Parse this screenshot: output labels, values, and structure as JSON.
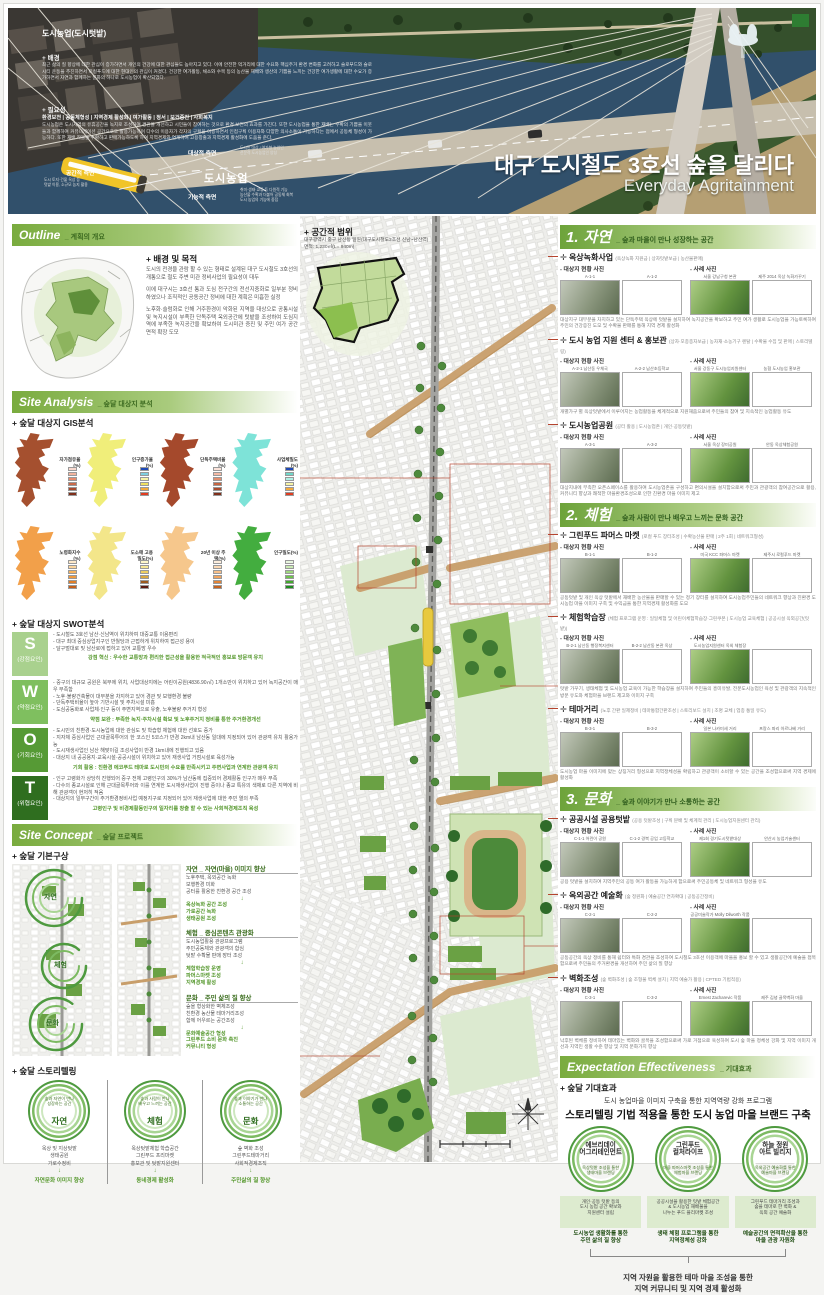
{
  "banner": {
    "photo_heading": "도시농업(도시텃밭)",
    "background_label": "+ 배경",
    "background_text": "최근 삶의 질 향상에 대한 관심이 증가하면서 개인의 건강에 대한 관심들도 높아지고 있다. 이에 안전한 먹거리에 대한 수요와 핵심주거 환경 변화를 고려하고 슬로푸드와 슬로시티 운동을 추진하면서 로컬푸드에 대한 현대인의 관심이 커졌다. 건강한 여가활동, 채소와 수목 등의 농산물 재배와 생산의 기쁨을 느끼는 건강한 여가생활에 대한 수요가 증가하면서 자연과 함께하는 문화의 하나로 도시농업이 확산되었다.",
    "need_label": "+ 필요성",
    "need_keywords": "환경보전 | 공동체형성 | 지역경제 활성화 | 여가활동 | 정서 | 보건증진 | 사회복지",
    "need_text": "도시농업은 도시지역의 유휴공간을 녹지로 조성하여 경관을 개선하고 시민들이 참여하는 것으로 환경 보전의 효과를 가진다. 또한 도시농업을 통한 재배는 수확의 기쁨을 이웃들과 함께하여 커뮤니케이션 공간으로도 활용가능하며 다수의 이용자가 각자의 구획을 이용하면서 인접구획 이용자와 다양한 의사소통이 가능하다는 점에서 공동체 형성이 가능하다. 또한 재배 작물을 수확하고 판매가능하도록 하여 지역경제와 연계하여 고용창출과 지역경제 활성화에 도움을 준다.",
    "diagram": {
      "center": "도시농업",
      "spatial_label": "공간적 측면",
      "spatial_desc": "도시 토지·건물 옥상 등\n텃밭 이용, 소규모 농지 활용",
      "target_label": "대상적 측면",
      "target_desc": "도시민 대상 / 여가형 농업인\n전문적 도시농업인 양성",
      "functional_label": "기능적 측면",
      "functional_desc": "취미·생태·교류 등 다원적 기능\n농산물 수확과 더불어 공동체 회복\n도시 농업의 기능에 중점"
    },
    "title_ko": "대구 도시철도 3호선 숲을 달리다",
    "title_en": "Everyday Agritainment"
  },
  "outline": {
    "header": "Outline",
    "header_sub": "_ 계획의 개요",
    "purpose_label": "+ 배경 및 목적",
    "purpose_items": [
      "도시의 전경을 관람 할 수 있는 형태로 설계된 대구 도시철도 3호선의 개통으로 철도 주변 미관 정비사업의 필요성이 대두",
      "이에 대구시는 3호선 통과 도심 전구간의 전선지중화로 일부분 정비하였으나 조직적인 공동공간 정비에 대한 계획은 미흡한 실정",
      "노후화·슬럼화로 인해 거주환경이 악화된 지역을 대상으로 공통시설 및 녹지시설이 부족한 단독주택 옥외공간에 텃밭을 조성하여 도심지역에 부족한 녹지공간을 확보하여 도시미관 증진 및 주민 여가 공간 면적 확장 도모"
    ],
    "scope_label": "+ 공간적 범위",
    "scope_text": "대구광역시 중구 남산동 일원(대구도시철도3호선 신남~남산역)",
    "scope_area": "면적: 1,230㎡(L= 940m)"
  },
  "analysis": {
    "header": "Site Analysis",
    "header_sub": "_ 숲달 대상지 분석",
    "gis_label": "+ 숲달 대상지 GIS분석",
    "gis_maps": [
      {
        "label": "자가점유율(%)",
        "color": "#a5502f",
        "legend": [
          "#f9d9cf",
          "#f2b49e",
          "#e68a6c",
          "#c96a4a",
          "#a84a2e",
          "#7e2f1a"
        ]
      },
      {
        "label": "인구증가율(%)",
        "color": "#f0ee7a",
        "legend": [
          "#1f49b5",
          "#7ecfe0",
          "#f6f3a5",
          "#f0e060",
          "#f2a93b",
          "#e03c20"
        ]
      },
      {
        "label": "단독주택비율(%)",
        "color": "#a5492c",
        "legend": [
          "#fbe3da",
          "#f3b9a4",
          "#e08d6e",
          "#c46542",
          "#a84a2e",
          "#7e2f1a"
        ]
      },
      {
        "label": "사업체밀도(%)",
        "color": "#7ee3d8",
        "legend": [
          "#1f49b5",
          "#6fd6c8",
          "#aef0e4",
          "#f6f3a5",
          "#f2a93b",
          "#e03c20"
        ]
      },
      {
        "label": "노령화지수(%)",
        "color": "#f2a04a",
        "legend": [
          "#fde8c8",
          "#fbd49b",
          "#f7b45e",
          "#f09a3e",
          "#e07f28",
          "#c45f1a"
        ]
      },
      {
        "label": "도소매 고용밀도(%)",
        "color": "#f3e68a",
        "legend": [
          "#fdf6c9",
          "#f7e795",
          "#eecf62",
          "#d9a83f",
          "#9c5a1e",
          "#5c1a10"
        ]
      },
      {
        "label": "20년 이상 주택(%)",
        "color": "#f6c78c",
        "legend": [
          "#fdeedd",
          "#fbd9b4",
          "#f7c08a",
          "#f0a45e",
          "#e08438",
          "#c4621f"
        ]
      },
      {
        "label": "인구밀도(%)",
        "color": "#43ad3f",
        "legend": [
          "#e8f6df",
          "#c8e9b2",
          "#9ed77f",
          "#6fc24f",
          "#42a82e",
          "#1f8c1f"
        ]
      }
    ],
    "swot_label": "+ 숲달 대상지 SWOT분석",
    "swot": [
      {
        "letter": "S",
        "label": "(강점요인)",
        "color": "#a9d18e",
        "bullets": [
          "도시철도 3호선 남산·신남역이 위치하여 대중교통 이용편리",
          "대구 최대 중심상업지구인 반월당과 근접하게 위치하여 접근성 용이",
          "달구벌대로 및 남산로에 접하고 있어 교통망 우수"
        ],
        "summary": "강점 혁신 : 우수한 교통망과 편리한 접근성을 활용한 적극적인 홍보로 방문객 유치"
      },
      {
        "letter": "W",
        "label": "(약점요인)",
        "color": "#7fbf5f",
        "bullets": [
          "중구의 대규모 공원은 북부에 위치, 사업대상지에는 어린이공원(4836.90㎡) 1개소만이 위치하고 있어 녹지공간이 매우 부족함",
          "노후·불량건축물이 대부분을 차지하고 있어 경관 및 보행환경 불량",
          "단독주택비율이 높아 기반시설 및 주차시설 미흡",
          "도심공동화로 사업체·인구 등이 주변지역으로 유출, 노후불량 주거지 형성"
        ],
        "summary": "약점 보완 : 부족한 녹지·주차시설 확보 및 노후주거지 정비를 통한 주거환경개선"
      },
      {
        "letter": "O",
        "label": "(기회요인)",
        "color": "#569a35",
        "bullets": [
          "도시민의 친환경·도시농업에 대한 관심도 및 학습형 체험에 대한 선호도 증가",
          "지자체 중심사업인 근대골목투어의 한 코스인 5코스가 반경 2km내 남산동 일대에 지정되어 있어 관광객 유치 활용가능",
          "도시재생사업인 남산 해맞이길 조성사업이 반경 1km내에 진행되고 있음",
          "대상지 내 공공용지·교육시설·공공시설이 위치하고 있어 재생사업 거점시설로 육성가능"
        ],
        "summary": "기회 활용 : 친환경 에코푸드 테마로 도시민의 수요를 만족시키고 주변사업과 연계한 관광객 유치"
      },
      {
        "letter": "T",
        "label": "(위협요인)",
        "color": "#2f6e1f",
        "bullets": [
          "인구 고령화가 상당히 진행되어 중구 전체 고령인구의 30%가 남산동에 집중되어 경제활동 인구가 매우 부족",
          "다수의 종교시설로 인해 근대골목투어와 이를 연계한 도시재생사업이 진행 중이나 종교 특유의 색채로 다른 지역에 비해 관광객이 현저히 적음",
          "대상지의 일부구간이 주거환경정비사업 예정지구로 지정되어 있어 재생사업에 대한 주민 열의 부족"
        ],
        "summary": "고령인구 및 비경제활동인구의 일자리를 창출 할 수 있는 사회적경제조직 육성"
      }
    ]
  },
  "concept": {
    "header": "Site Concept",
    "header_sub": "_ 숲달 프로젝트",
    "basic_label": "+ 숲달 기본구상",
    "themes": [
      {
        "title": "자연 _ 자연(마을) 이미지 향상",
        "items": "노후주택, 옥외공간 녹화\n보행환경 미화\n공터를 활용한 친환경 공간 조성",
        "result": "옥상녹화 공간 조성\n가로공간 녹화\n생태공원 조성"
      },
      {
        "title": "체험 _ 중심콘텐츠 관광화",
        "items": "도시농업활용 관광프로그램\n주민공동체와 관광객의 합심\n텃밭 수확물 판매 장터 조성",
        "result": "체험학습장 운영\n파머스마켓 조성\n지역경제 활성"
      },
      {
        "title": "문화 _ 주민 삶의 질 향상",
        "items": "숲을 형상화한 벽체조성\n친환경 농산물 테마거리조성\n함께 어우르는 공간조성",
        "result": "문화예술공간 형성\n그린푸드 소비 문화 촉진\n커뮤니티 형성"
      }
    ],
    "story_label": "+ 숲달 스토리텔링",
    "stories": [
      {
        "tagline": "숲과 자연이 만나\n성장하는 공간",
        "name": "자연",
        "items": "옥상 및 지상텃밭\n생태공원\n가로수정비",
        "result": "자연문화 이미지 향상"
      },
      {
        "tagline": "숲과 사람이 만나\n배우고 느끼는 공간",
        "name": "체험",
        "items": "옥상텃밭체험 학습공간\n그린푸드 프리마켓\n홍보관 및 텃밭지원센터",
        "result": "동네경제 활성화"
      },
      {
        "tagline": "숲과 이야기가 만나\n소통하는 공간",
        "name": "문화",
        "items": "숲 벽화 조성\n그린푸드테마거리\n사회적경제조직",
        "result": "주민삶의 질 향상"
      }
    ]
  },
  "labels": {
    "site_photos": "- 대상지 현황 사진",
    "case_photos": "- 사례 사진",
    "arrow": "↓"
  },
  "sections": [
    {
      "num": "1.",
      "name": "자연",
      "tagline": "_ 숲과 마을이 만나 성장하는 공간",
      "programs": [
        {
          "title": "옥상녹화사업",
          "tags": "(옥상녹화 지원금 | 상자텃밭보급 | 농산물판매)",
          "site_photos": [
            {
              "label": "A-1-1"
            },
            {
              "label": "A-1-2"
            }
          ],
          "case_photos": [
            {
              "label": "서울 강남구청 본관"
            },
            {
              "label": "제주 2014 옥상 녹화가꾸기"
            }
          ],
          "caption": "대상지구 대부분을 차지하고 있는 단독주택 옥상에 텃밭을 설치하여 녹지공간을 확보하고 주민 여가 생활로 도시농업을 가능토록하여 주민의 건강증진 도모 및 수확물 판매를 통해 지역 경제 활성화"
        },
        {
          "title": "도시 농업 지원 센터 & 홍보관",
          "tags": "(상자·모종종자보급 | 농자재·소농기구 렌탈 | 수확물 수집 및 판매 | 스토리텔링)",
          "site_photos": [
            {
              "label": "A-2-1 남산동 우체국"
            },
            {
              "label": "A-2-2 남산초등학교"
            }
          ],
          "case_photos": [
            {
              "label": "서울 강동구 도시농업지원센터"
            },
            {
              "label": "농협 도시농업 홍보관"
            }
          ],
          "caption": "개별가구 별 옥상텃밭에서 이루어지는 농업활동을 체계적으로 지원해줌으로써 주민들의 참여 및 지속적인 농업활동 유도"
        },
        {
          "title": "도시농업공원",
          "tags": "(공터 활용 | 도시농업존 | 개인·공동텃밭)",
          "site_photos": [
            {
              "label": "A-3-1"
            },
            {
              "label": "A-3-2"
            }
          ],
          "case_photos": [
            {
              "label": "서울 옥상 장미공원"
            },
            {
              "label": "안동 옥상체험공원"
            }
          ],
          "caption": "대상지내에 부족한 오픈스페이스를 활용하여 도시농업존을 구성하고 편의시설을 설치함으로써 주민과 관광객의 참여공간으로 활용, 커뮤니티 향상과 쾌적한 마을환경조성으로 인한 친환경 마을 이미지 제고"
        }
      ]
    },
    {
      "num": "2.",
      "name": "체험",
      "tagline": "_ 숲과 사람이 만나 배우고 느끼는 문화 공간",
      "programs": [
        {
          "title": "그린푸드 파머스 마켓",
          "tags": "(로컬 푸드 장터조성 | 수확농산물 판매 | 2주 1회 | 네트워크형성)",
          "site_photos": [
            {
              "label": "B-1-1"
            },
            {
              "label": "B-1-2"
            }
          ],
          "case_photos": [
            {
              "label": "미국 KCC 파머스 마켓"
            },
            {
              "label": "제주시 로컬푸드 마켓"
            }
          ],
          "caption": "공동텃밭 및 개인 옥상 텃밭에서 재배한 농산물을 판매할 수 있는 정기 장터를 설치하여 도시농업주민들의 네트워크 향상과 친환경 도시농업 마을 이미지 구축 및 수익금을 통한 지역경제 활성화를 도모"
        },
        {
          "title": "체험학습장",
          "tags": "(체험 프로그램 운영 : 일일체험 및 어린이체험학습장·그린쿠폰 | 도시농업 교육체험 | 공공시설 옥외공간(텃밭))",
          "site_photos": [
            {
              "label": "B-2-1 남산동 행정복지센터"
            },
            {
              "label": "B-2-2 남산동 본관 옥상"
            }
          ],
          "case_photos": [
            {
              "label": "도시농업지원센터 옥외 체험장"
            },
            {
              "label": ""
            }
          ],
          "caption": "텃밭 가꾸기, 생태체험 및 도시농업 교육이 가능한 학습장을 설치하여 주민들의 흥미유발, 전문도시농업인 육성 및 관광객의 지속적인 방문 유도와 체험마을 브랜드 제고와 이미지 구축"
        },
        {
          "title": "테마거리",
          "tags": "(노후 간판 일제정비 | 테마통합간판조성 | 스토리보드 설치 | 조명 교체 | 업종 통일 유도)",
          "site_photos": [
            {
              "label": "B-3-1"
            },
            {
              "label": "B-3-2"
            }
          ],
          "case_photos": [
            {
              "label": "일본 나카미세 거리"
            },
            {
              "label": "프랑스 파리 아르나베 거리"
            }
          ],
          "caption": "도시농업 마을 이미지에 맞는 상징거리 형성으로 지역정체성을 확립하고 관광객이 소비할 수 있는 공간을 조성함으로써 지역 경제에 활성화"
        }
      ]
    },
    {
      "num": "3.",
      "name": "문화",
      "tagline": "_ 숲과 이야기가 만나 소통하는 공간",
      "programs": [
        {
          "title": "공공시설 공용텃밭",
          "tags": "(공용 텃밭조성 | 구획 분배 및 체계적 관리 | 도시농업지원센터 관리)",
          "site_photos": [
            {
              "label": "C-1-1 어린이 공원"
            },
            {
              "label": "C-1-2 경북 공업 고등학교"
            }
          ],
          "case_photos": [
            {
              "label": "제1회 경기도시텃밭대상"
            },
            {
              "label": "안산시 농업기술센터"
            }
          ],
          "caption": "공용 텃밭을 설치하여 지역주민의 공동 여가 활동을 가능하게 함으로써 주민공동체 및 네트워크 형성을 유도"
        },
        {
          "title": "옥외공간 예술화",
          "tags": "(숲 정원화 | 예술공간 연차확대 | 공동공간정비)",
          "site_photos": [
            {
              "label": "C-2-1"
            },
            {
              "label": "C-2-2"
            }
          ],
          "case_photos": [
            {
              "label": "공공미술작가 Molly Dilworth 작품"
            },
            {
              "label": ""
            }
          ],
          "caption": "공동공간의 옥상 정비를 통해 쉼터와 특화 경관을 조성하여 도시철도 3호선 이용객에 마을을 홍보 할 수 있고 생활공간에 예술을 접목함으로써 주민들의 주거환경을 개선하여 주민 삶의 질 향상"
        },
        {
          "title": "벽화조성",
          "tags": "(숲 벽화조성 | 숲 조형물 벽체 설치 | 지역 예술가 활용 | CPTED 기법적용)",
          "site_photos": [
            {
              "label": "C-3-1"
            },
            {
              "label": "C-3-2"
            }
          ],
          "case_photos": [
            {
              "label": "Ernest Zacharevic 작품"
            },
            {
              "label": "제주 김녕 골목벽화 마을"
            }
          ],
          "caption": "낙후된 벽체를 정비하여 테마있는 벽화와 골목을 조성함으로써 가로 거점으로 육성하여 도시 숲 마을 정체성 강화 및 지역 이미지 개선과 지역민 생활 수준 향상 및 지역 문화가치 향상"
        }
      ]
    }
  ],
  "expectation": {
    "header": "Expectation Effectiveness",
    "header_sub": "_ 기대효과",
    "label": "+ 숲달 기대효과",
    "line1": "도시 농업마을 이미지 구축을 통한 지역역량 강화 프로그램",
    "line2": "스토리텔링 기법 적용을 통한 도시 농업 마을 브랜드 구축",
    "pillars": [
      {
        "name": "에브리데이\n어그리테인먼트",
        "sub": "옥상텃밭 조성을 통한\n생태마을 브랜딩",
        "box": "개인·공동 텃밭 등의\n도시 농업 공간 확보와\n지원센터 설립",
        "result": "도시농업 생활화를 통한\n주민 삶의 질 향상"
      },
      {
        "name": "그린푸드\n컬처라이프",
        "sub": "마을 파머스마켓 조성을 통한\n체험마을 브랜딩",
        "box": "공공시설을 활용한 텃밭 체험공간\n& 도시농업 재배물을\n나누는 푸드 플리마켓 조성",
        "result": "생태 체험 프로그램을 통한\n지역정체성 강화"
      },
      {
        "name": "하늘 정원\n아트 빌리지",
        "sub": "옥외공간 예술화를 통한\n예술마을 브랜딩",
        "box": "그린푸드 테마거리 조성과\n숲을 테마로 한 벽화 &\n옥외 공간 예술화",
        "result": "예술공간의 면적확산을 통한\n마을 관광 자원화"
      }
    ],
    "final": "지역 자원을 활용한 테마 마을 조성을 통한\n지역 커뮤니티 및 지역 경제 활성화"
  }
}
